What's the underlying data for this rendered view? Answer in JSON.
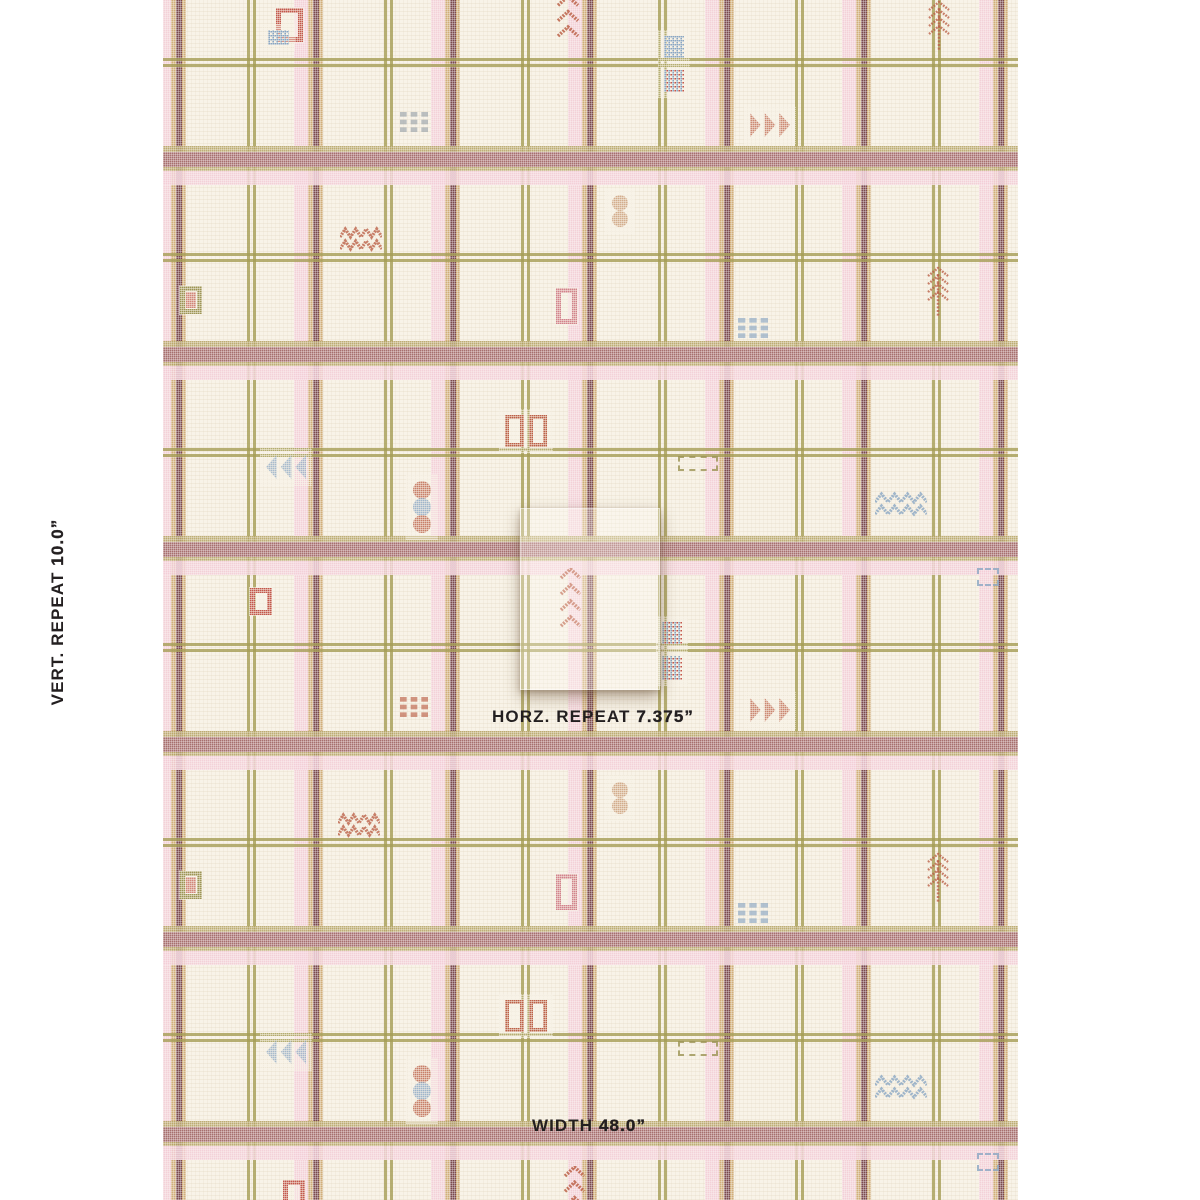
{
  "labels": {
    "text_color": "#231f20",
    "vert": {
      "prefix": "VERT. REPEAT ",
      "value": "10.0”"
    },
    "horz": {
      "prefix": "HORZ. REPEAT ",
      "value": "7.375”"
    },
    "width": {
      "prefix": "WIDTH ",
      "value": "48.0”"
    }
  },
  "fabric": {
    "area": {
      "left": 163,
      "top": 0,
      "width": 855,
      "height": 1200
    },
    "base_color": "#f8f3e8",
    "stripe_colors": {
      "maroon": "#a76f6e",
      "maroon_dark": "#7b494d",
      "gold": "#cda76e",
      "gold_line": "#b5a262",
      "olive": "#a59d55",
      "pink": "#f3ccd6"
    },
    "motif_colors": {
      "rust": "#bc6148",
      "red": "#c2574b",
      "blue": "#8aa6c3",
      "tan": "#c99b76",
      "olive": "#9c9454",
      "gray": "#9aa3ab",
      "pink_red": "#d2828b"
    },
    "vertical_groups": [
      157,
      294,
      431,
      568,
      705,
      842,
      979
    ],
    "vertical_lines": [
      247,
      384,
      521,
      658,
      795,
      932
    ],
    "horizontal_bands": [
      146,
      341,
      536,
      731,
      926,
      1121
    ],
    "horizontal_lines": [
      58,
      253,
      448,
      643,
      838,
      1033
    ],
    "motifs": [
      {
        "type": "frame",
        "x": 276,
        "y": 8,
        "w": 27,
        "h": 34,
        "color": "red"
      },
      {
        "type": "grid",
        "x": 268,
        "y": 30,
        "w": 21,
        "h": 15,
        "color": "blue",
        "color2": "blue"
      },
      {
        "type": "chevrons",
        "x": 556,
        "y": -20,
        "w": 24,
        "h": 58,
        "color": "rust",
        "n": 4
      },
      {
        "type": "grid",
        "x": 664,
        "y": 36,
        "w": 20,
        "h": 22,
        "color": "blue",
        "color2": "blue"
      },
      {
        "type": "grid",
        "x": 664,
        "y": 70,
        "w": 20,
        "h": 22,
        "color": "blue",
        "color2": "red"
      },
      {
        "type": "grid9",
        "x": 400,
        "y": 112,
        "w": 28,
        "h": 20,
        "color": "gray"
      },
      {
        "type": "tri-right",
        "x": 750,
        "y": 112,
        "w": 40,
        "h": 26,
        "color": "rust"
      },
      {
        "type": "dots2",
        "x": 611,
        "y": 194,
        "w": 18,
        "h": 34,
        "color": "tan"
      },
      {
        "type": "zigzag",
        "x": 340,
        "y": 224,
        "w": 42,
        "h": 28,
        "color": "rust"
      },
      {
        "type": "frame",
        "x": 180,
        "y": 286,
        "w": 22,
        "h": 28,
        "color": "olive",
        "inner": "red"
      },
      {
        "type": "feather",
        "x": 926,
        "y": 0,
        "w": 26,
        "h": 52,
        "color": "rust"
      },
      {
        "type": "feather",
        "x": 925,
        "y": 266,
        "w": 26,
        "h": 52,
        "color": "rust"
      },
      {
        "type": "frame",
        "x": 556,
        "y": 288,
        "w": 21,
        "h": 36,
        "color": "pink_red"
      },
      {
        "type": "grid9",
        "x": 738,
        "y": 318,
        "w": 30,
        "h": 20,
        "color": "blue"
      },
      {
        "type": "frame2",
        "x": 505,
        "y": 415,
        "w": 42,
        "h": 32,
        "color": "rust"
      },
      {
        "type": "tri-left",
        "x": 266,
        "y": 454,
        "w": 40,
        "h": 26,
        "color": "blue"
      },
      {
        "type": "dashrect",
        "x": 678,
        "y": 456,
        "w": 40,
        "h": 15,
        "color": "olive"
      },
      {
        "type": "dots3",
        "x": 412,
        "y": 480,
        "w": 20,
        "h": 54,
        "colors": [
          "rust",
          "blue",
          "rust"
        ]
      },
      {
        "type": "zigzag",
        "x": 875,
        "y": 489,
        "w": 52,
        "h": 32,
        "color": "blue"
      },
      {
        "type": "dashsq",
        "x": 977,
        "y": 568,
        "w": 22,
        "h": 18,
        "color": "blue"
      },
      {
        "type": "frame",
        "x": 250,
        "y": 588,
        "w": 22,
        "h": 27,
        "color": "red"
      },
      {
        "type": "chevrons",
        "x": 559,
        "y": 568,
        "w": 23,
        "h": 60,
        "color": "rust",
        "n": 4
      },
      {
        "type": "grid",
        "x": 662,
        "y": 622,
        "w": 20,
        "h": 22,
        "color": "blue",
        "color2": "red"
      },
      {
        "type": "grid",
        "x": 662,
        "y": 656,
        "w": 20,
        "h": 24,
        "color": "blue",
        "color2": "red"
      },
      {
        "type": "grid9",
        "x": 400,
        "y": 697,
        "w": 28,
        "h": 20,
        "color": "rust"
      },
      {
        "type": "tri-right",
        "x": 750,
        "y": 697,
        "w": 40,
        "h": 26,
        "color": "rust"
      },
      {
        "type": "dots2",
        "x": 611,
        "y": 781,
        "w": 18,
        "h": 34,
        "color": "tan"
      },
      {
        "type": "zigzag",
        "x": 338,
        "y": 810,
        "w": 42,
        "h": 28,
        "color": "rust"
      },
      {
        "type": "frame",
        "x": 180,
        "y": 871,
        "w": 22,
        "h": 28,
        "color": "olive",
        "inner": "red"
      },
      {
        "type": "feather",
        "x": 925,
        "y": 852,
        "w": 26,
        "h": 52,
        "color": "rust"
      },
      {
        "type": "frame",
        "x": 556,
        "y": 874,
        "w": 21,
        "h": 36,
        "color": "pink_red"
      },
      {
        "type": "grid9",
        "x": 738,
        "y": 903,
        "w": 30,
        "h": 20,
        "color": "blue"
      },
      {
        "type": "frame2",
        "x": 505,
        "y": 1000,
        "w": 42,
        "h": 32,
        "color": "rust"
      },
      {
        "type": "tri-left",
        "x": 266,
        "y": 1039,
        "w": 40,
        "h": 26,
        "color": "blue"
      },
      {
        "type": "dashrect",
        "x": 678,
        "y": 1041,
        "w": 40,
        "h": 15,
        "color": "olive"
      },
      {
        "type": "dots3",
        "x": 412,
        "y": 1064,
        "w": 20,
        "h": 54,
        "colors": [
          "rust",
          "blue",
          "rust"
        ]
      },
      {
        "type": "zigzag",
        "x": 875,
        "y": 1072,
        "w": 52,
        "h": 32,
        "color": "blue"
      },
      {
        "type": "dashsq",
        "x": 977,
        "y": 1153,
        "w": 22,
        "h": 18,
        "color": "blue"
      },
      {
        "type": "frame",
        "x": 283,
        "y": 1180,
        "w": 22,
        "h": 28,
        "color": "red"
      },
      {
        "type": "chevrons",
        "x": 563,
        "y": 1166,
        "w": 23,
        "h": 58,
        "color": "rust",
        "n": 4
      }
    ]
  },
  "swatch": {
    "left": 520,
    "top": 508,
    "width": 138,
    "height": 180
  }
}
